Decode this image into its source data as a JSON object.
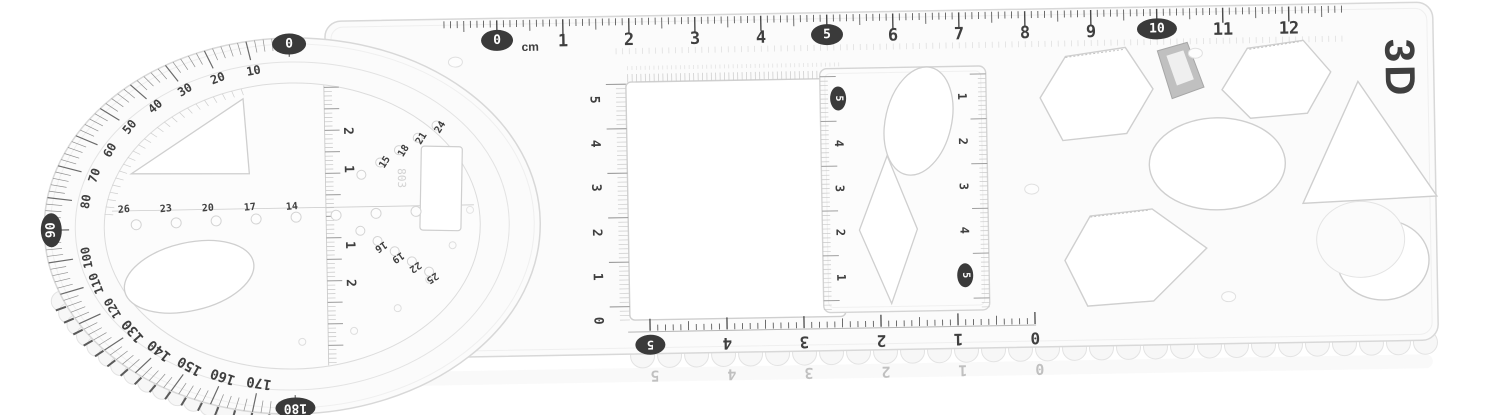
{
  "scene": {
    "background": "#ffffff",
    "description": "Clear plastic multifunctional geometric drawing template ruler with protractor disc, shape cutouts and several scale rulers, photographed on a white background"
  },
  "palette": {
    "plastic": "#fbfbfb",
    "edge": "#d8d8d8",
    "ink": "#3f3f3f",
    "badge_bg": "#3a3a3a",
    "badge_fg": "#ffffff"
  },
  "brand": {
    "logo_text": "3D",
    "mold_code": "803"
  },
  "top_ruler": {
    "unit": "cm",
    "numbers": [
      "0",
      "1",
      "2",
      "3",
      "4",
      "5",
      "6",
      "7",
      "8",
      "9",
      "10",
      "11",
      "12"
    ],
    "badged_values": [
      "0",
      "5",
      "10"
    ]
  },
  "protractor": {
    "degrees": [
      "0",
      "10",
      "20",
      "30",
      "40",
      "50",
      "60",
      "70",
      "80",
      "90",
      "100",
      "110",
      "120",
      "130",
      "140",
      "150",
      "160",
      "170",
      "180"
    ],
    "badged_values": [
      "0",
      "90",
      "180"
    ],
    "center_scale_labels": [
      "2",
      "1",
      "1",
      "2"
    ],
    "hole_row_left": [
      "26",
      "23",
      "20",
      "17",
      "14"
    ],
    "hole_row_upper_right": [
      "15",
      "18",
      "21",
      "24"
    ],
    "hole_row_lower_right": [
      "16",
      "19",
      "22",
      "25"
    ]
  },
  "square_window": {
    "left_scale": [
      "5",
      "4",
      "3",
      "2",
      "1",
      "0"
    ]
  },
  "bottom_ruler": {
    "numbers": [
      "5",
      "4",
      "3",
      "2",
      "1",
      "0"
    ],
    "badged_values": [
      "5"
    ]
  },
  "template_card": {
    "left_scale": [
      "5",
      "4",
      "3",
      "2",
      "1"
    ],
    "left_badged": "5",
    "right_scale": [
      "1",
      "2",
      "3",
      "4",
      "5"
    ],
    "right_badged": "5"
  }
}
